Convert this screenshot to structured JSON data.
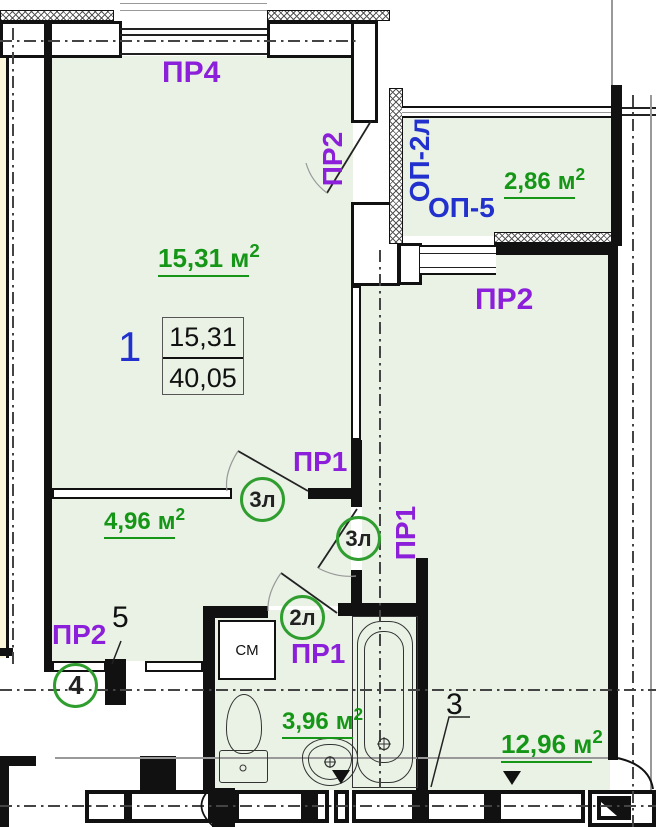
{
  "colors": {
    "room_fill": "#e9f2e5",
    "adjacent_fill": "#fcf6da",
    "label_purple": "#8c1fd9",
    "label_blue": "#2231cd",
    "label_green": "#169617",
    "circle_green": "#2f9e2f"
  },
  "labels": {
    "pr4": "ПР4",
    "pr2_balcony_door": "ПР2",
    "op_2l": "ОП-2л",
    "op_5": "ОП-5",
    "pr2_kitchen": "ПР2",
    "pr1_hall": "ПР1",
    "pr1_kitchen": "ПР1",
    "pr1_bath": "ПР1",
    "pr2_entry": "ПР2"
  },
  "areas": {
    "living": {
      "value": "15,31",
      "unit": "м",
      "sup": "2"
    },
    "balcony": {
      "value": "2,86",
      "unit": "м",
      "sup": "2"
    },
    "hall": {
      "value": "4,96",
      "unit": "м",
      "sup": "2"
    },
    "bath": {
      "value": "3,96",
      "unit": "м",
      "sup": "2"
    },
    "kitchen": {
      "value": "12,96",
      "unit": "м",
      "sup": "2"
    }
  },
  "room1": {
    "number": "1",
    "ratio_numerator": "15,31",
    "ratio_denominator": "40,05"
  },
  "door_circles": {
    "hall_living": "3л",
    "hall_kitchen": "3л",
    "bath": "2л"
  },
  "axis_marks": {
    "circle_4": "4",
    "mark_5": "5",
    "mark_3": "3"
  },
  "fixtures": {
    "washing_machine": "СМ"
  }
}
